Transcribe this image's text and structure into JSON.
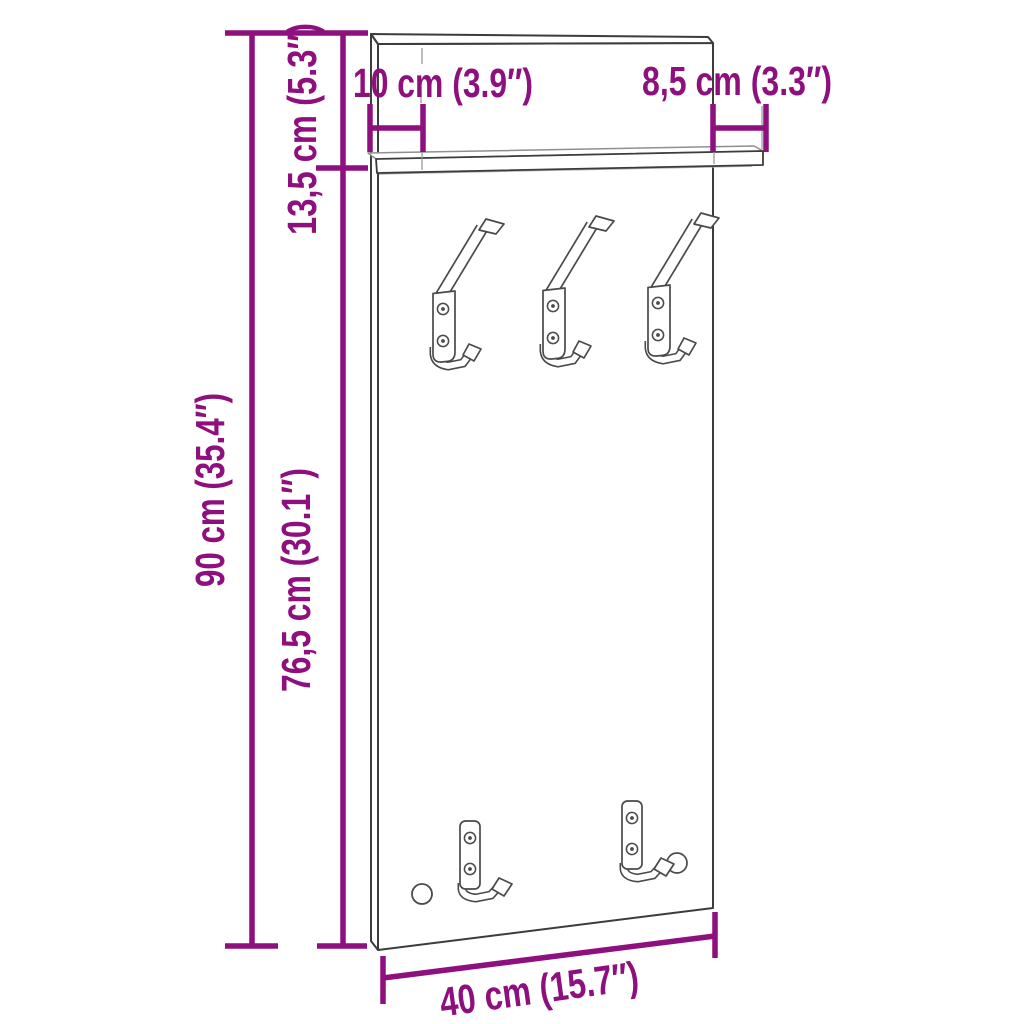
{
  "diagram": {
    "description": "Technical dimension drawing of a wall-mounted coat rack panel with top shelf, three double coat hooks and two single hooks",
    "background_color": "#ffffff",
    "line_color": "#3c3c3c",
    "dimension_color": "#8e0f7e",
    "labels": {
      "top_left_width": "10 cm (3.9″)",
      "top_right_width": "8,5 cm (3.3″)",
      "upper_height": "13,5 cm (5.3″)",
      "total_height": "90 cm (35.4″)",
      "lower_height": "76,5 cm (30.1″)",
      "bottom_width": "40 cm (15.7″)"
    },
    "features": {
      "upper_double_hooks": 3,
      "lower_single_hooks": 2,
      "shelf": true,
      "mounting_hole": true
    }
  }
}
